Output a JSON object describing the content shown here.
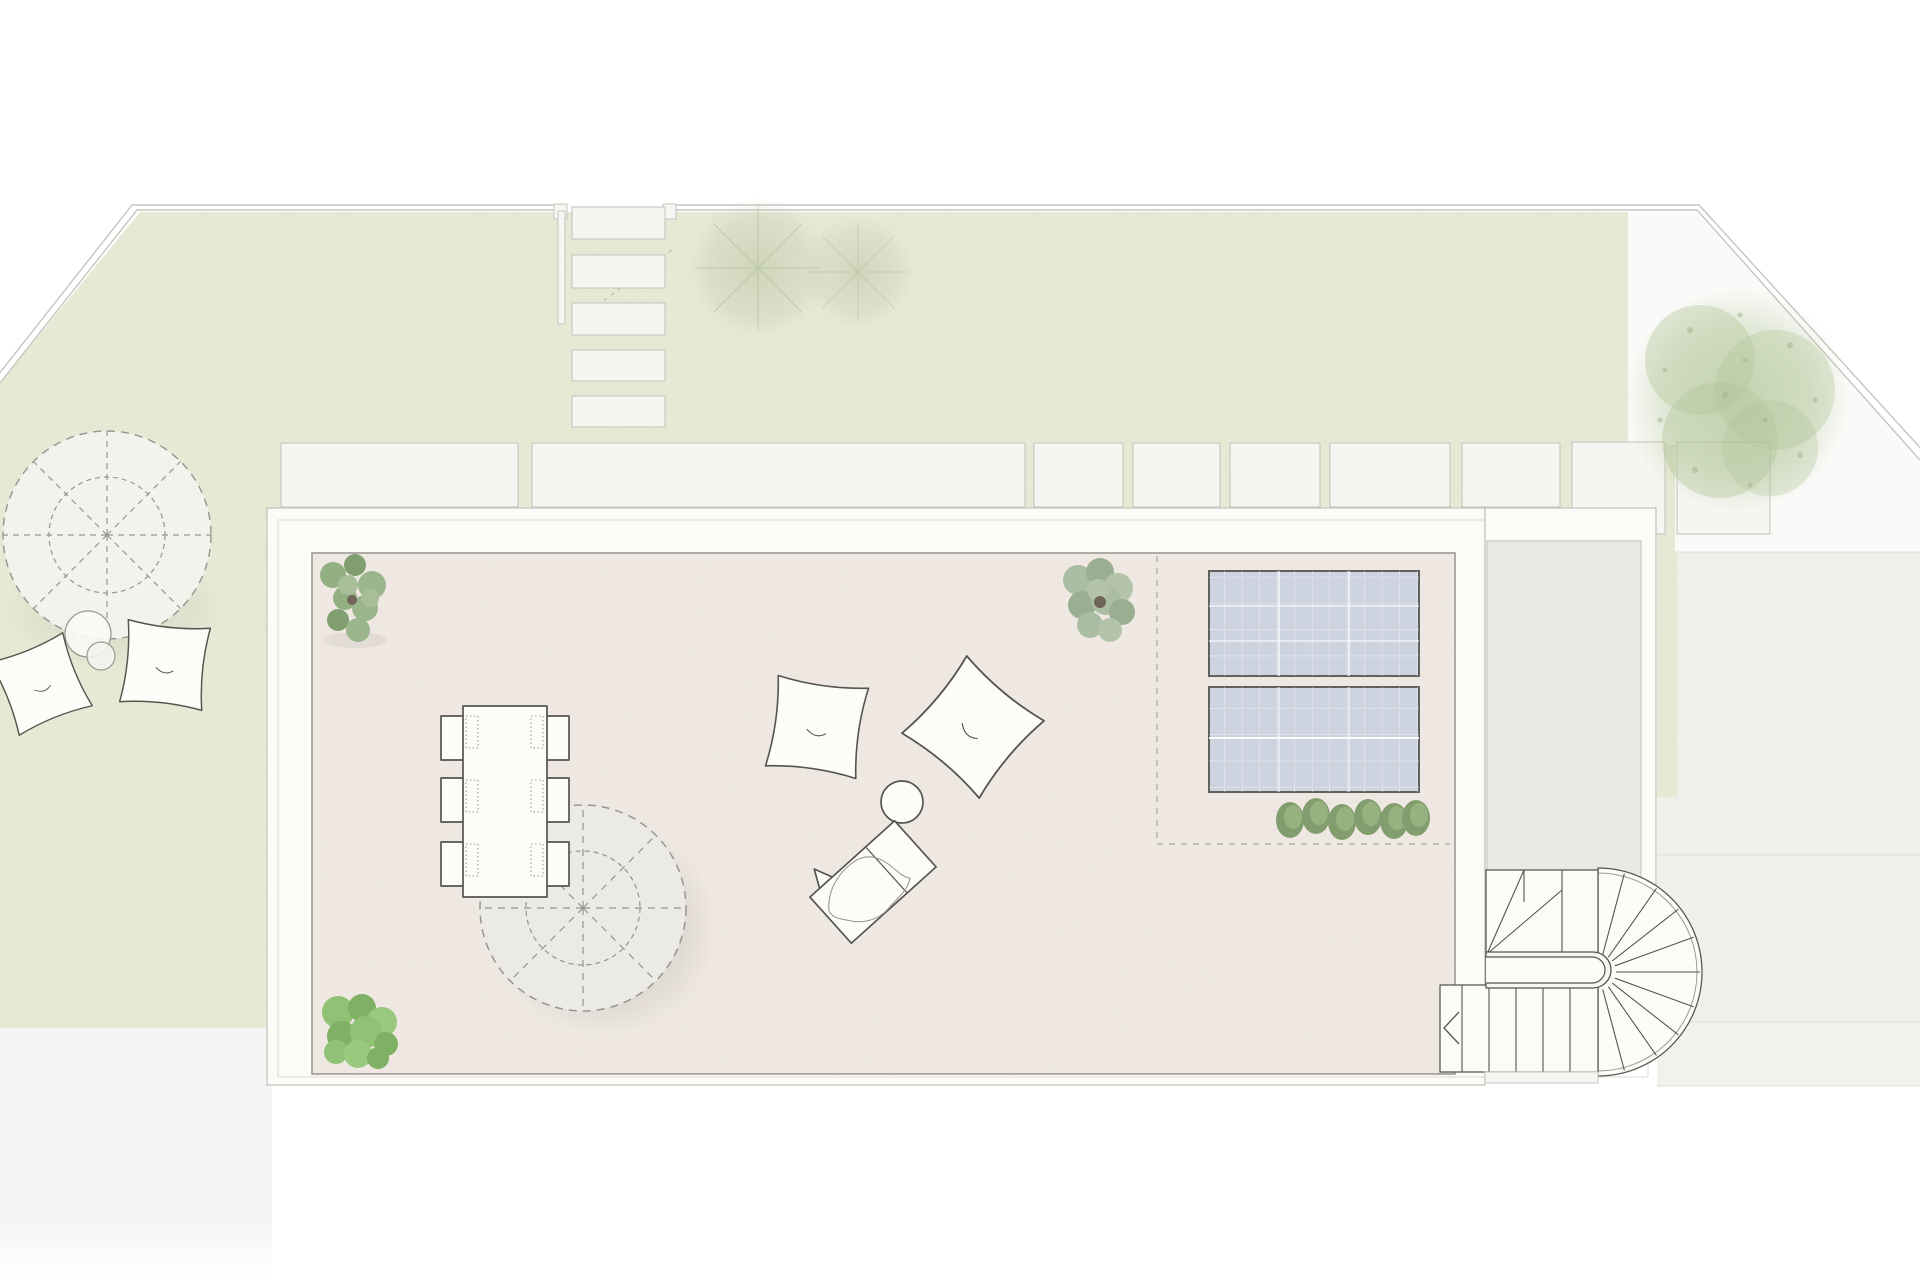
{
  "meta": {
    "type": "architectural-site-plan",
    "view": "top-down roof terrace and garden plan",
    "text_content": "none"
  },
  "colors": {
    "page_bg": "#ffffff",
    "lawn": "#e7e9d5",
    "gravel": "#fafaf8",
    "waterside": "#f4f6f5",
    "drive_upper": "#f1efea",
    "drive_lower": "#f3f1ed",
    "white_surface": "#f6f5f1",
    "band_white": "#fcfbf8",
    "terrace_floor": "#efe8e2",
    "wing_floor": "#ebe9e4",
    "furn_white": "#fcfcf9",
    "parasol_fill": "#eceae6",
    "parasol_fill_garden": "#f3f2ec",
    "outline_dark": "#55544e",
    "outline_mid": "#9a9993",
    "outline_light": "#c6c5bf",
    "dash_gray": "#96958f",
    "faint_line": "#dfddd7",
    "panel_fill": "#cdd4df",
    "panel_border": "#60605c",
    "panel_grid": "#edf0f5",
    "plant_1": "#8fae7f",
    "plant_2": "#7d9c6d",
    "plant_3": "#98b489",
    "plant_4": "#a5bd97",
    "sage_1": "#a9bca0",
    "sage_2": "#97ac8e",
    "sage_3": "#b2c3a9",
    "bush_1": "#8dc172",
    "bush_2": "#7cb061",
    "bush_3": "#96c87c",
    "grass_1": "#7a9865",
    "grass_2": "#8fae77",
    "tree_faint": "#a6b48f",
    "tree_big": "#b2c598",
    "trunk": "#6b6052",
    "shadow": "#78766c"
  },
  "elements": {
    "site": [
      "site-boundary-wall",
      "lawn",
      "gravel-area-top-right",
      "gravel-area-bottom-left",
      "driveway-court"
    ],
    "landscape": [
      {
        "name": "stepping-stones",
        "count": 5
      },
      {
        "name": "gate-posts",
        "count": 2
      },
      {
        "name": "paver-slabs",
        "count": 9
      },
      {
        "name": "sketch-trees-faint",
        "count": 2
      },
      {
        "name": "large-tree",
        "count": 1
      },
      {
        "name": "ornamental-grasses",
        "count": 6
      },
      {
        "name": "shrub-planting",
        "count": 3
      }
    ],
    "terrace": {
      "structure": [
        "roof-terrace-parapet",
        "terrace-floor",
        "side-wing",
        "horseshoe-staircase",
        "stair-direction-arrow"
      ],
      "furniture": [
        {
          "name": "dining-table",
          "count": 1
        },
        {
          "name": "dining-chairs",
          "count": 6
        },
        {
          "name": "parasols-dashed",
          "count": 2
        },
        {
          "name": "bean-bag-chairs",
          "count": 4
        },
        {
          "name": "coffee-table-round",
          "count": 1
        },
        {
          "name": "garden-side-tables",
          "count": 2
        },
        {
          "name": "sun-lounger",
          "count": 1
        }
      ],
      "equipment": [
        {
          "name": "solar-panels",
          "count": 2
        },
        {
          "name": "solar-zone-dashed-outline",
          "count": 1
        }
      ]
    }
  }
}
